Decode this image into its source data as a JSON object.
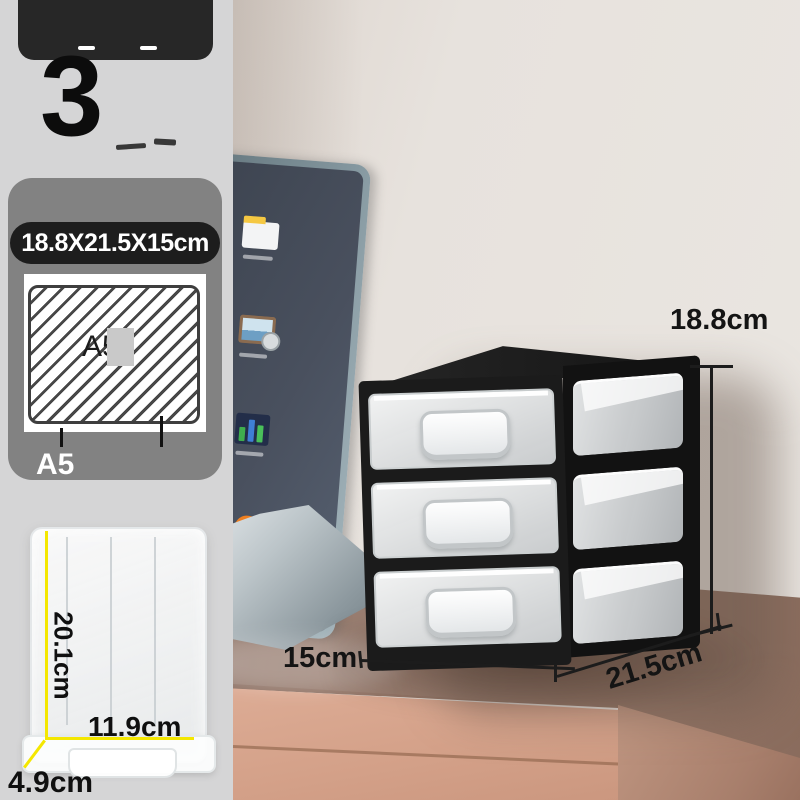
{
  "sidebar": {
    "badge_number": "3",
    "spec_pill": "18.8X21.5X15cm",
    "paper_watermark": "A5",
    "paper_label": "A5",
    "diagram": {
      "depth": "20.1cm",
      "width": "11.9cm",
      "height": "4.9cm"
    }
  },
  "scene": {
    "annotations": {
      "height": "18.8cm",
      "depth": "15cm",
      "width": "21.5cm"
    },
    "laptop_icons": [
      "folder-icon",
      "picture-icon",
      "bar-chart-icon",
      "flame-icon",
      "app-dot-icon"
    ]
  },
  "colors": {
    "accent_yellow": "#f4e700",
    "panel_gray": "#828282",
    "banner_black": "#272727",
    "wall_beige": "#e8e3de",
    "desk_top_brown": "#8f7263",
    "desk_front_pink": "#d8a68f",
    "product_black": "#1b1b1b"
  }
}
